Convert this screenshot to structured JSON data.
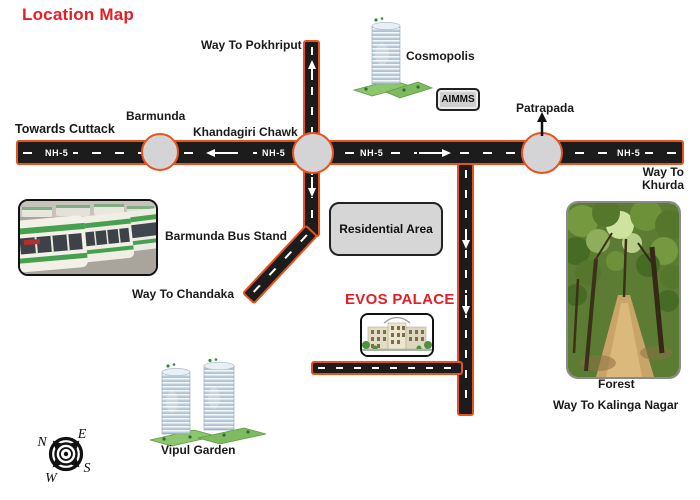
{
  "title": "Location Map",
  "colors": {
    "accent_red": "#e21f26",
    "road_fill": "#1c1c1c",
    "road_border": "#e8531c",
    "junction_fill": "#d4d4d6",
    "box_fill": "#d6d6d6",
    "dash_white": "#ffffff"
  },
  "highway": {
    "route_labels": [
      "NH-5",
      "NH-5",
      "NH-5",
      "NH-5"
    ],
    "towards_cuttack": "Towards Cuttack",
    "way_to_khurda": [
      "Way To",
      "Khurda"
    ]
  },
  "junctions": {
    "barmunda": "Barmunda",
    "khandagiri": "Khandagiri Chawk",
    "patrapada": "Patrapada"
  },
  "branch_roads": {
    "pokhriput": "Way To Pokhriput",
    "chandaka": "Way To Chandaka",
    "kalinga": "Way To Kalinga Nagar"
  },
  "landmarks": {
    "cosmopolis": "Cosmopolis",
    "aimms": "AIMMS",
    "residential_area": "Residential Area",
    "evos_palace": "EVOS PALACE",
    "bus_stand": "Barmunda Bus Stand",
    "vipul_garden": "Vipul Garden",
    "forest": "Forest"
  },
  "compass": {
    "n": "N",
    "e": "E",
    "s": "S",
    "w": "W"
  }
}
